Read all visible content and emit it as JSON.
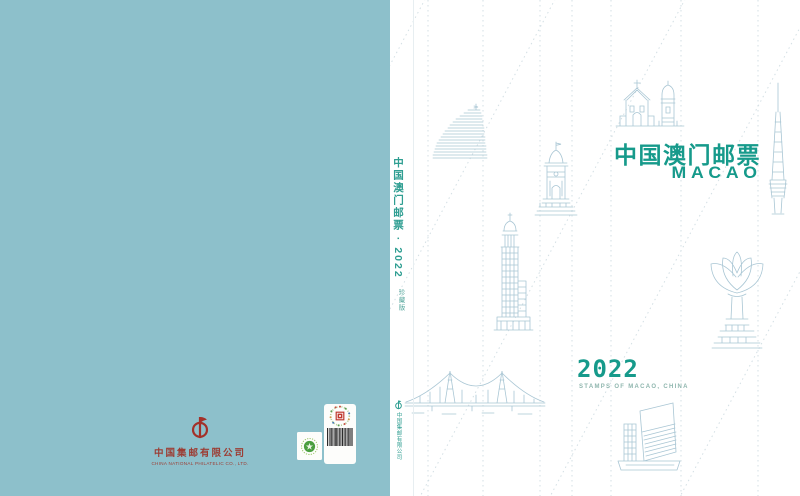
{
  "back_cover": {
    "publisher_name_cn": "中国集邮有限公司",
    "publisher_name_en": "CHINA NATIONAL PHILATELIC CO., LTD.",
    "marks": {
      "publisher_logo": "china-philatelic-logo",
      "green_mark": "green-printing-certification-mark",
      "barcode_label": "anti-counterfeit-barcode-label"
    }
  },
  "spine": {
    "title": "中国澳门邮票 · 2022",
    "edition": "珍藏版",
    "publisher": "中国集邮有限公司",
    "logo": "china-philatelic-logo"
  },
  "front_cover": {
    "title_cn": "中国澳门邮票",
    "title_en": "MACAO",
    "year": "2022",
    "subtitle": "STAMPS OF MACAO, CHINA",
    "landmark_icons": [
      "grand-lisboa-hotel",
      "gate-tower",
      "bank-of-china-tower",
      "guia-chapel-and-lighthouse",
      "macau-tower",
      "lotus-square-sculpture",
      "sai-van-bridge",
      "macao-cultural-centre"
    ]
  },
  "colors": {
    "back_cover_teal": "#8dc0cb",
    "accent_green": "#169a8b",
    "spine_green": "#2f9e92",
    "line_art_blue": "#a9c6d4",
    "dotted_line": "#d3dfe4",
    "logo_red": "#a33129",
    "publisher_text_red": "#9c3c33"
  }
}
